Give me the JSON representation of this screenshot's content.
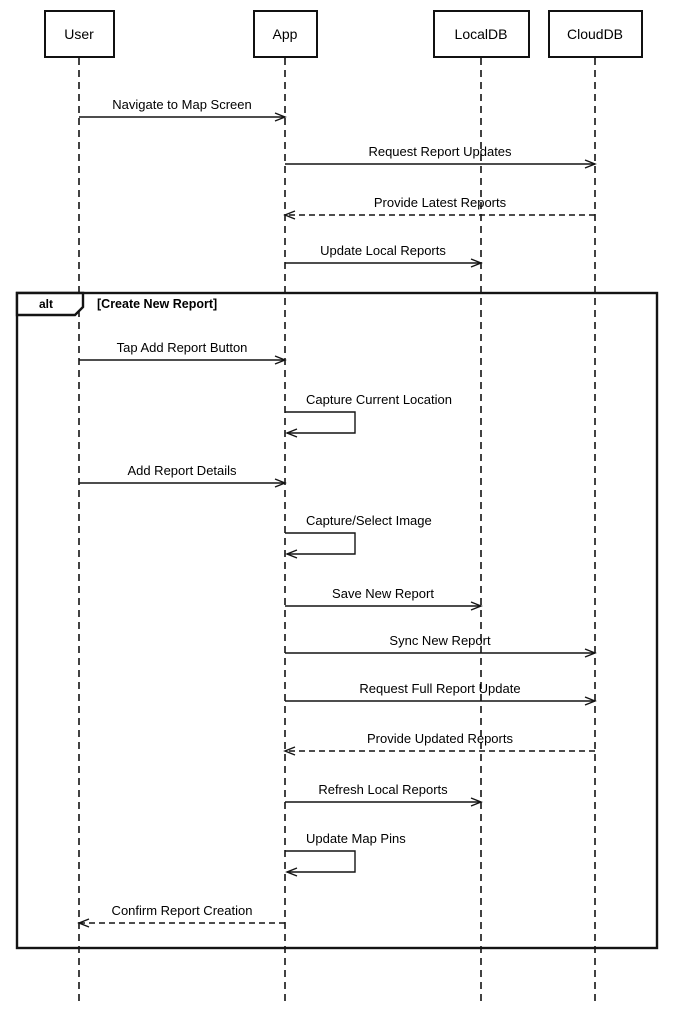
{
  "diagram": {
    "type": "uml-sequence-diagram",
    "background": "#ffffff",
    "line_color": "#141414"
  },
  "layout": {
    "width": 675,
    "height": 1010,
    "lifeline_top": 58,
    "lifeline_bottom": 1003,
    "self_loop_w": 70,
    "self_loop_h": 21
  },
  "actors": [
    {
      "name": "User",
      "cx": 79,
      "box_w": 71
    },
    {
      "name": "App",
      "cx": 285,
      "box_w": 65
    },
    {
      "name": "LocalDB",
      "cx": 481,
      "box_w": 97
    },
    {
      "name": "CloudDB",
      "cx": 595,
      "box_w": 95
    }
  ],
  "fragment": {
    "operator": "alt",
    "condition": "[Create New Report]",
    "x": 17,
    "y": 293,
    "w": 640,
    "h": 655,
    "label_w": 66,
    "label_h": 22,
    "notch": 8
  },
  "messages": [
    {
      "label": "Navigate to Map Screen",
      "from": "User",
      "to": "App",
      "style": "solid",
      "y": 117
    },
    {
      "label": "Request Report Updates",
      "from": "App",
      "to": "CloudDB",
      "style": "solid",
      "y": 164
    },
    {
      "label": "Provide Latest Reports",
      "from": "CloudDB",
      "to": "App",
      "style": "dashed",
      "y": 215
    },
    {
      "label": "Update Local Reports",
      "from": "App",
      "to": "LocalDB",
      "style": "solid",
      "y": 263
    },
    {
      "label": "Tap Add Report Button",
      "from": "User",
      "to": "App",
      "style": "solid",
      "y": 360
    },
    {
      "label": "Capture Current Location",
      "from": "App",
      "to": "App",
      "style": "self",
      "y": 412
    },
    {
      "label": "Add Report Details",
      "from": "User",
      "to": "App",
      "style": "solid",
      "y": 483
    },
    {
      "label": "Capture/Select Image",
      "from": "App",
      "to": "App",
      "style": "self",
      "y": 533
    },
    {
      "label": "Save New Report",
      "from": "App",
      "to": "LocalDB",
      "style": "solid",
      "y": 606
    },
    {
      "label": "Sync New Report",
      "from": "App",
      "to": "CloudDB",
      "style": "solid",
      "y": 653
    },
    {
      "label": "Request Full Report Update",
      "from": "App",
      "to": "CloudDB",
      "style": "solid",
      "y": 701
    },
    {
      "label": "Provide Updated Reports",
      "from": "CloudDB",
      "to": "App",
      "style": "dashed",
      "y": 751
    },
    {
      "label": "Refresh Local Reports",
      "from": "App",
      "to": "LocalDB",
      "style": "solid",
      "y": 802
    },
    {
      "label": "Update Map Pins",
      "from": "App",
      "to": "App",
      "style": "self",
      "y": 851
    },
    {
      "label": "Confirm Report Creation",
      "from": "App",
      "to": "User",
      "style": "dashed",
      "y": 923
    }
  ]
}
